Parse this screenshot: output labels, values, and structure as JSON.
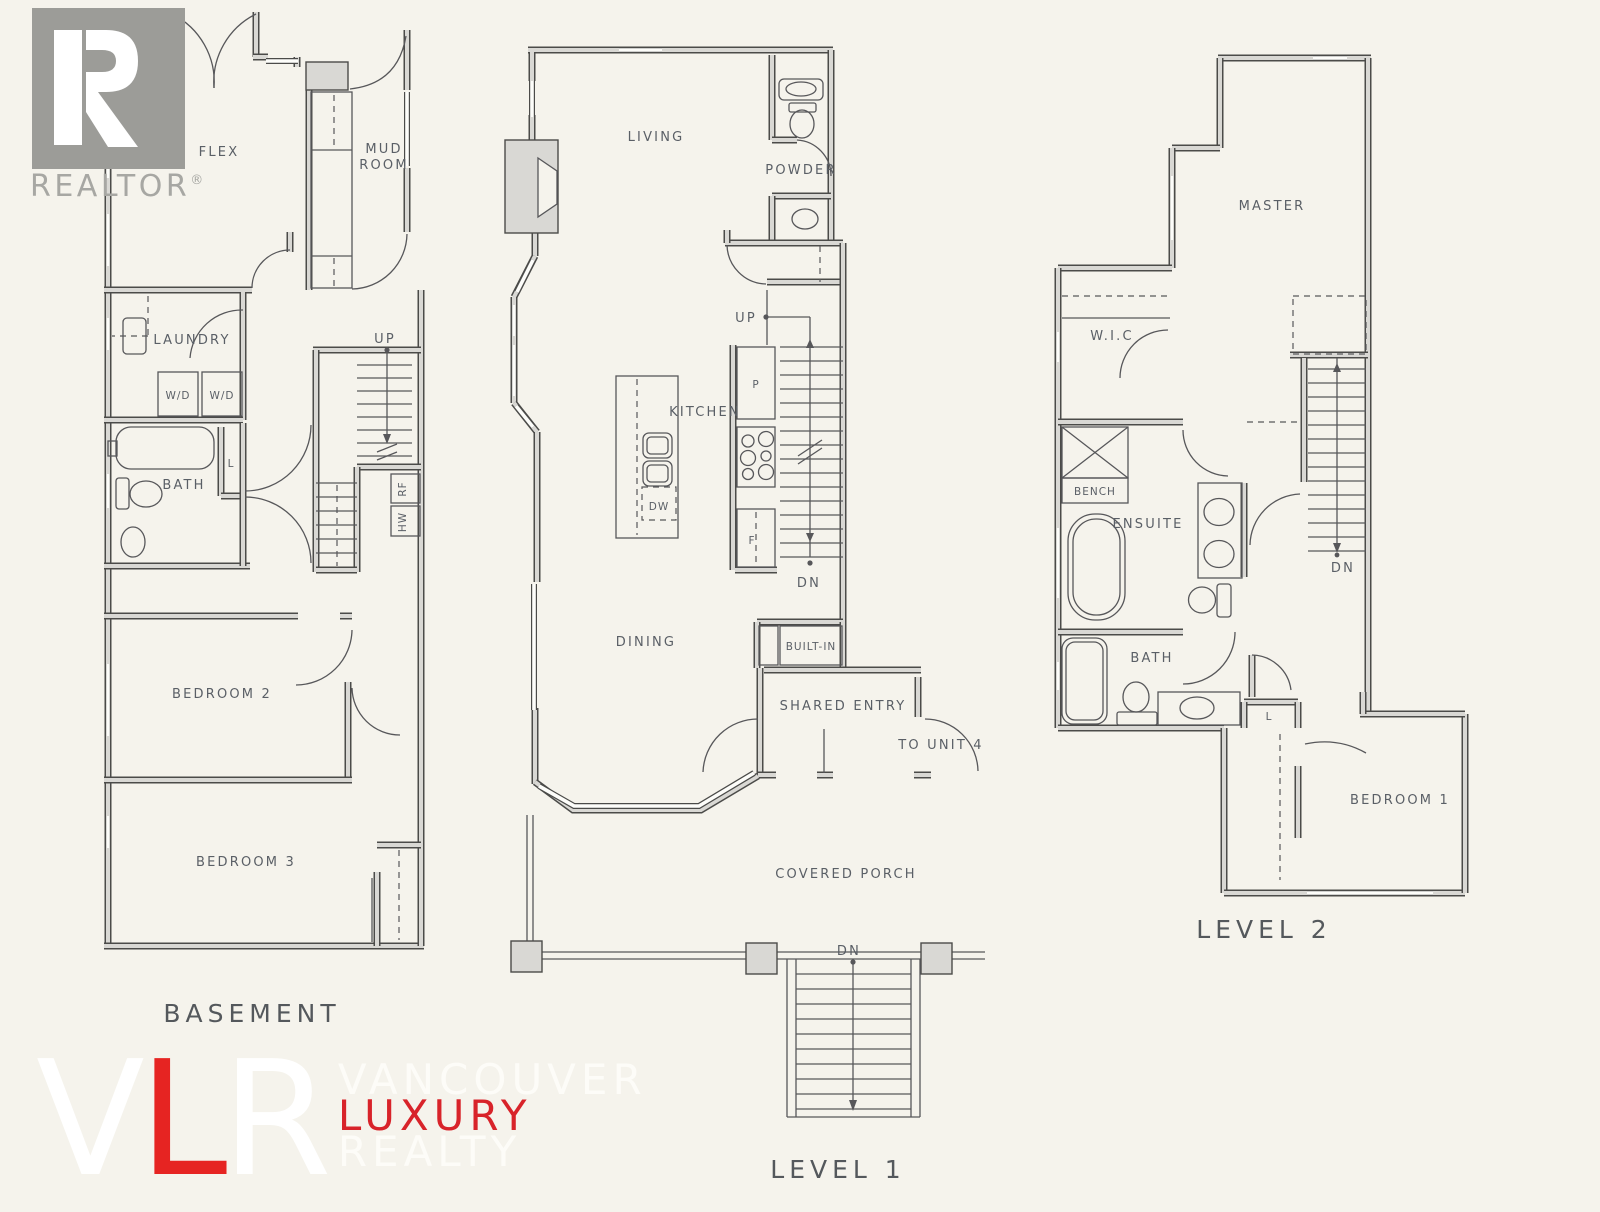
{
  "branding": {
    "realtor": {
      "r": "R",
      "name": "REALTOR",
      "reg": "®"
    },
    "watermark": {
      "v": "V",
      "l": "L",
      "r": "R",
      "word1": "VANCOUVER",
      "word2": "LUXURY",
      "word3": "REALTY"
    }
  },
  "plans": {
    "basement": {
      "title": "BASEMENT",
      "rooms": {
        "flex": "FLEX",
        "mud": "MUD",
        "room": "ROOM",
        "laundry": "LAUNDRY",
        "wd1": "W/D",
        "wd2": "W/D",
        "bath": "BATH",
        "l": "L",
        "up": "UP",
        "rf": "RF",
        "hw": "HW",
        "bedroom2": "BEDROOM 2",
        "bedroom3": "BEDROOM 3"
      }
    },
    "level1": {
      "title": "LEVEL 1",
      "rooms": {
        "living": "LIVING",
        "powder": "POWDER",
        "up": "UP",
        "kitchen": "KITCHEN",
        "p": "P",
        "dw": "DW",
        "f": "F",
        "dn": "DN",
        "dining": "DINING",
        "builtin": "BUILT-IN",
        "shared_entry": "SHARED ENTRY",
        "to_unit4": "TO UNIT 4",
        "covered_porch": "COVERED PORCH",
        "porch_dn": "DN"
      }
    },
    "level2": {
      "title": "LEVEL 2",
      "rooms": {
        "master": "MASTER",
        "wic": "W.I.C",
        "bench": "BENCH",
        "ensuite": "ENSUITE",
        "dn": "DN",
        "bath": "BATH",
        "l": "L",
        "bedroom1": "BEDROOM 1"
      }
    }
  },
  "colors": {
    "background": "#f5f3ec",
    "wall_edge": "#4b4b49",
    "wall_fill": "#d9d8d4",
    "text": "#5a5f66",
    "brand_red": "#e62422",
    "logo_gray": "#9c9c98",
    "watermark_white": "#ffffff"
  }
}
